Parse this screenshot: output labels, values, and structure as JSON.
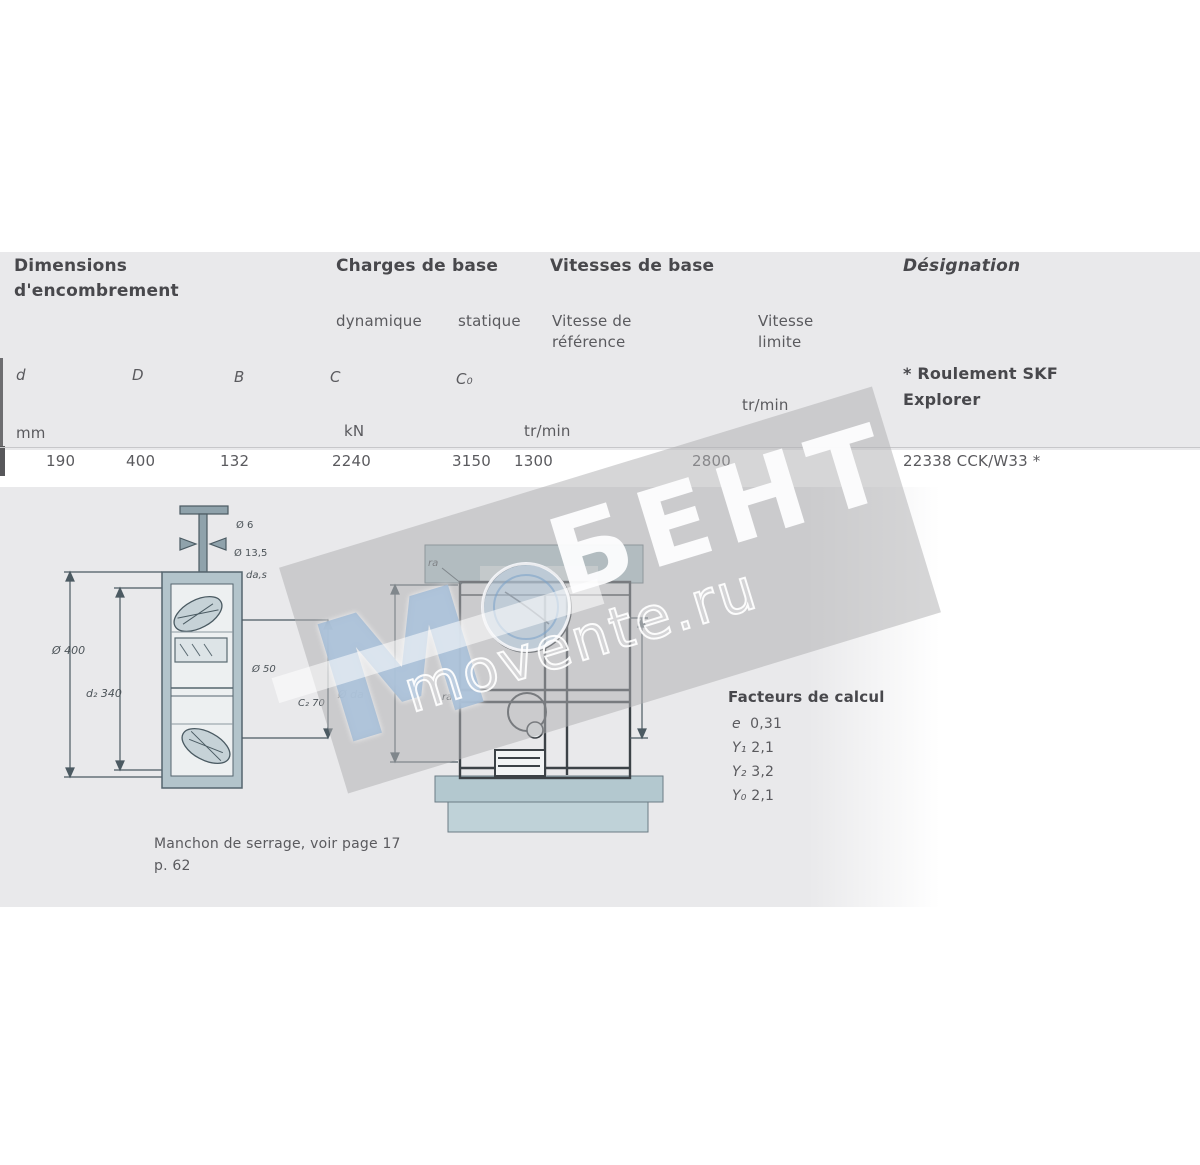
{
  "table": {
    "group_headers": {
      "dimensions_line1": "Dimensions",
      "dimensions_line2": "d'encombrement",
      "loads": "Charges de base",
      "speeds": "Vitesses de base",
      "designation": "Désignation"
    },
    "sub_headers": {
      "dynamic": "dynamique",
      "static": "statique",
      "ref_line1": "Vitesse de",
      "ref_line2": "référence",
      "lim_line1": "Vitesse",
      "lim_line2": "limite"
    },
    "symbols": {
      "d": "d",
      "D": "D",
      "B": "B",
      "C": "C",
      "C0": "C₀"
    },
    "explorer_note_line1": "* Roulement SKF",
    "explorer_note_line2": "Explorer",
    "units": {
      "mm": "mm",
      "kN": "kN",
      "rpm_ref": "tr/min",
      "rpm_lim": "tr/min"
    },
    "row": {
      "d": "190",
      "D": "400",
      "B": "132",
      "C": "2240",
      "C0": "3150",
      "v_ref": "1300",
      "v_lim": "2800",
      "designation": "22338 CCK/W33 *"
    }
  },
  "calc_factors": {
    "title": "Facteurs de calcul",
    "rows": [
      {
        "sym": "e",
        "val": "0,31"
      },
      {
        "sym": "Y₁",
        "val": "2,1"
      },
      {
        "sym": "Y₂",
        "val": "3,2"
      },
      {
        "sym": "Y₀",
        "val": "2,1"
      }
    ]
  },
  "footnote": {
    "line1": "Manchon de serrage, voir page 17",
    "line2": "p. 62"
  },
  "drawings": {
    "left": {
      "outer_dia": "Ø 400",
      "inner_dia": "d₂ 340",
      "lube_hole": "Ø 6",
      "lube_groove": "Ø 13,5",
      "abutment": "da,s",
      "right_dia": "Ø 50",
      "right_c": "C₂ 70"
    },
    "middle": {
      "left_dia": "Ø da",
      "fillet_top": "ra",
      "fillet_bottom": "ra"
    }
  },
  "watermark": {
    "brand": "БЕНТ",
    "site": "movente.ru",
    "logo_letter": "M"
  },
  "colors": {
    "accent_teal": "#b3c6cc",
    "panel_gray": "#e9e9eb",
    "watermark_blue": "#a0bad4"
  }
}
